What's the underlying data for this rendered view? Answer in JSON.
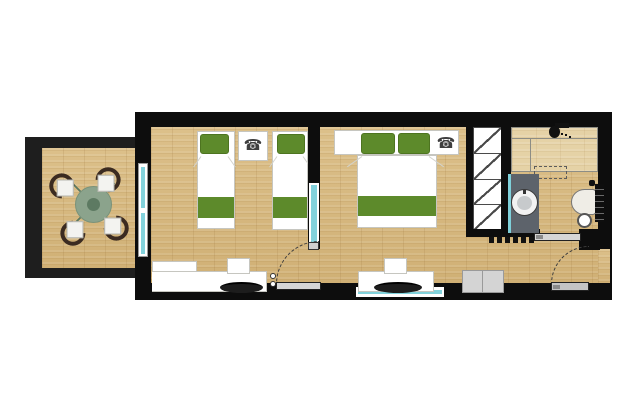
{
  "page": {
    "type": "architectural-floor-plan",
    "background": "#ffffff"
  },
  "icons": {
    "telephone_glyph": "☎",
    "telephone": "telephone-icon",
    "shower_head": "shower-head-icon",
    "tv": "tv-top-view-icon",
    "washbasin": "round-washbasin-icon",
    "toilet": "toilet-top-view-icon"
  },
  "palette": {
    "wall": "#0d0d0d",
    "balcony_wall": "#1e1e1e",
    "floor_wood": "#d7ba82",
    "shower_floor": "#e5d2a6",
    "bed_green": "#5d8a2b",
    "glass_teal": "#82d2dc",
    "table_green": "#8ba38c",
    "table_center_green": "#5d7a62",
    "chair_back_brown": "#3b2b21",
    "vanity_gray": "#5d636b",
    "door_leaf_gray": "#d6d6d6",
    "cabinet_gray": "#d4d4d4"
  },
  "rooms": [
    {
      "id": "balcony",
      "furniture": [
        "round-dining-table",
        "dining-chair",
        "dining-chair",
        "dining-chair",
        "dining-chair"
      ]
    },
    {
      "id": "bedroom-1",
      "furniture": [
        "twin-bed",
        "twin-bed",
        "nightstand-with-telephone",
        "desk-with-tv",
        "desk-chair",
        "interior-door"
      ]
    },
    {
      "id": "bedroom-2",
      "furniture": [
        "double-bed",
        "nightstand-with-telephone",
        "desk-with-tv",
        "desk-chair",
        "window"
      ]
    },
    {
      "id": "hallway",
      "furniture": [
        "built-in-wardrobe",
        "low-cabinet",
        "entrance-door"
      ]
    },
    {
      "id": "bathroom",
      "furniture": [
        "shower",
        "vanity-with-washbasin",
        "toilet",
        "sliding-door"
      ]
    }
  ],
  "counts": {
    "doors": 3,
    "windows": 3,
    "beds": 3,
    "telephones": 2
  }
}
